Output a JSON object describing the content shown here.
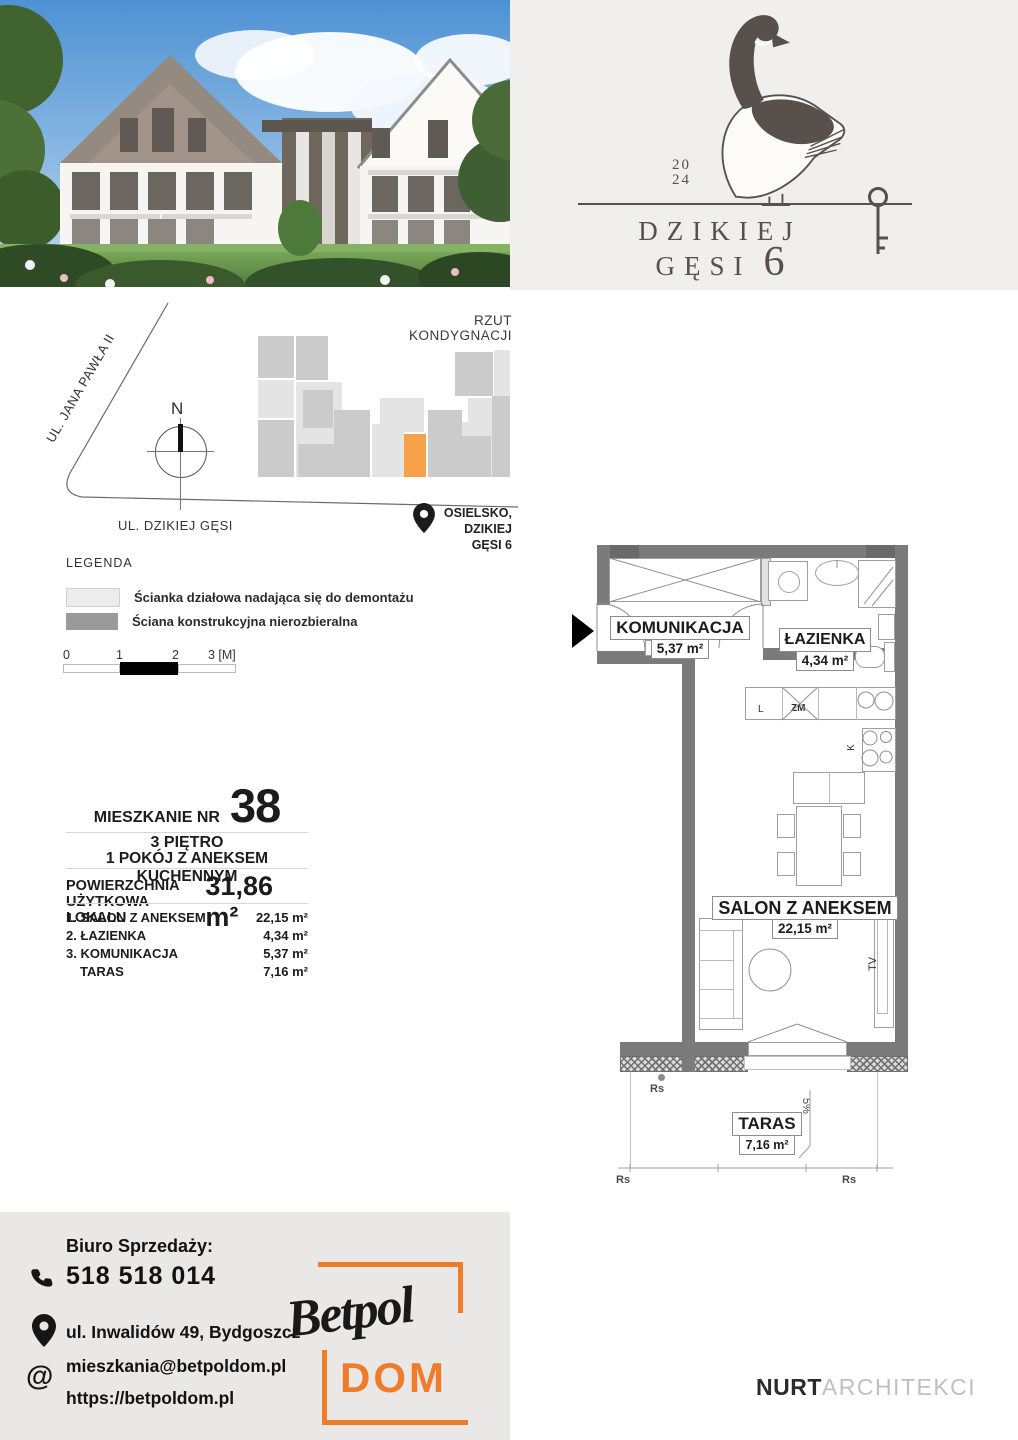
{
  "colors": {
    "accent_orange": "#f7a24a",
    "betpol_orange": "#ed7c2b",
    "wall_gray": "#7b7b7b",
    "logo_panel_gray": "#f0efee",
    "contact_card_gray": "#e9e8e7",
    "logo_ink": "#57504b"
  },
  "header_logo": {
    "year_top": "20",
    "year_bottom": "24",
    "title_line1": "DZIKIEJ",
    "title_line2": "GĘSI",
    "number": "6"
  },
  "site_plan": {
    "title": "RZUT KONDYGNACJI",
    "street_diagonal": "UL. JANA PAWŁA II",
    "street_bottom": "UL. DZIKIEJ GĘSI",
    "compass": "N",
    "location_line1": "OSIELSKO,",
    "location_line2": "DZIKIEJ GĘSI 6",
    "blocks": [
      {
        "x": 258,
        "y": 336,
        "w": 36,
        "h": 42,
        "t": "mid"
      },
      {
        "x": 296,
        "y": 336,
        "w": 32,
        "h": 44,
        "t": "mid"
      },
      {
        "x": 258,
        "y": 380,
        "w": 36,
        "h": 38,
        "t": "light"
      },
      {
        "x": 258,
        "y": 420,
        "w": 36,
        "h": 57,
        "t": "mid"
      },
      {
        "x": 296,
        "y": 382,
        "w": 46,
        "h": 95,
        "t": "light"
      },
      {
        "x": 303,
        "y": 390,
        "w": 30,
        "h": 38,
        "t": "mid"
      },
      {
        "x": 298,
        "y": 444,
        "w": 36,
        "h": 33,
        "t": "mid"
      },
      {
        "x": 334,
        "y": 410,
        "w": 36,
        "h": 67,
        "t": "mid"
      },
      {
        "x": 372,
        "y": 424,
        "w": 32,
        "h": 53,
        "t": "light"
      },
      {
        "x": 380,
        "y": 398,
        "w": 44,
        "h": 34,
        "t": "light"
      },
      {
        "x": 428,
        "y": 410,
        "w": 34,
        "h": 67,
        "t": "mid"
      },
      {
        "x": 462,
        "y": 422,
        "w": 30,
        "h": 55,
        "t": "light"
      },
      {
        "x": 455,
        "y": 352,
        "w": 38,
        "h": 44,
        "t": "mid"
      },
      {
        "x": 494,
        "y": 350,
        "w": 16,
        "h": 46,
        "t": "light"
      },
      {
        "x": 468,
        "y": 398,
        "w": 42,
        "h": 36,
        "t": "light"
      },
      {
        "x": 492,
        "y": 396,
        "w": 18,
        "h": 81,
        "t": "mid"
      },
      {
        "x": 455,
        "y": 436,
        "w": 36,
        "h": 41,
        "t": "mid"
      },
      {
        "x": 404,
        "y": 434,
        "w": 22,
        "h": 43,
        "t": "orange"
      }
    ]
  },
  "legend": {
    "title": "LEGENDA",
    "items": [
      {
        "label": "Ścianka działowa nadająca się do demontażu"
      },
      {
        "label": "Ściana konstrukcyjna nierozbieralna"
      }
    ],
    "scale": {
      "t0": "0",
      "t1": "1",
      "t2": "2",
      "t3": "3 [M]"
    }
  },
  "unit_info": {
    "label": "MIESZKANIE NR",
    "number": "38",
    "floor": "3 PIĘTRO",
    "type": "1 POKÓJ Z ANEKSEM KUCHENNYM",
    "area_label1": "POWIERZCHNIA",
    "area_label2": "UŻYTKOWA LOKALU",
    "area_value": "31,86 m²",
    "rooms": [
      {
        "name": "1. SALON Z ANEKSEM",
        "area": "22,15 m²"
      },
      {
        "name": "2. ŁAZIENKA",
        "area": "4,34 m²"
      },
      {
        "name": "3. KOMUNIKACJA",
        "area": "5,37 m²"
      },
      {
        "name": "TARAS",
        "area": "7,16 m²"
      }
    ]
  },
  "floor_plan": {
    "rooms": {
      "komunikacja": {
        "name": "KOMUNIKACJA",
        "area": "5,37 m²"
      },
      "lazienka": {
        "name": "ŁAZIENKA",
        "area": "4,34 m²"
      },
      "salon": {
        "name": "SALON Z ANEKSEM",
        "area": "22,15 m²"
      },
      "taras": {
        "name": "TARAS",
        "area": "7,16 m²"
      }
    },
    "labels": {
      "fridge": "L",
      "dishwasher": "ZM",
      "stove": "K",
      "tv": "TV",
      "slope": "5%",
      "drain": "Rs"
    }
  },
  "contact": {
    "heading": "Biuro Sprzedaży:",
    "phone": "518 518 014",
    "address": "ul. Inwalidów 49, Bydgoszcz",
    "email": "mieszkania@betpoldom.pl",
    "website": "https://betpoldom.pl"
  },
  "brand": {
    "script": "Betpol",
    "sub": "DOM"
  },
  "architect": {
    "bold": "NURT",
    "light": "ARCHITEKCI"
  }
}
